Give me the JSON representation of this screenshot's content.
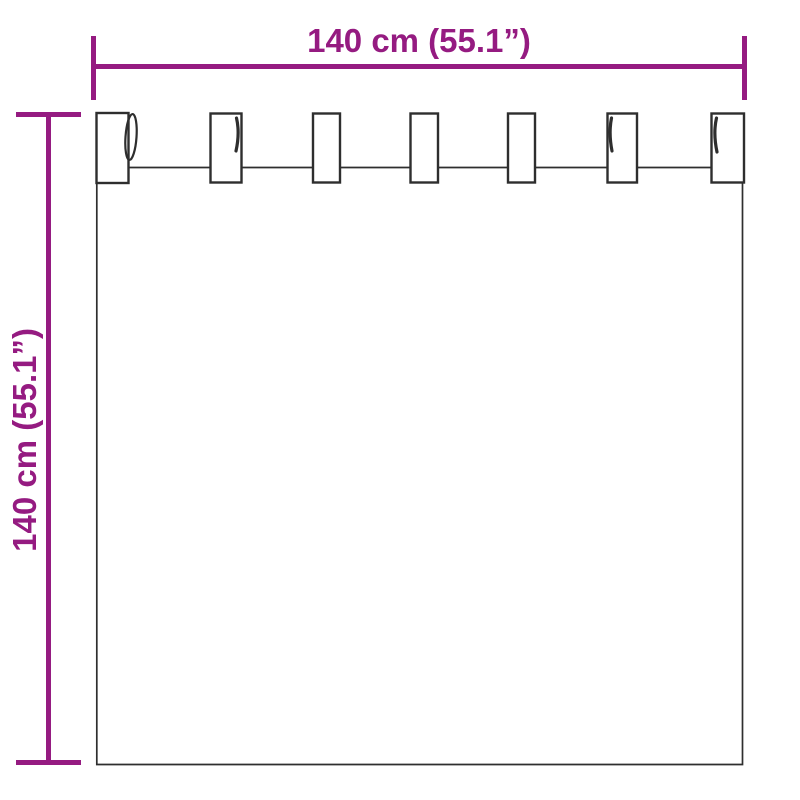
{
  "diagram": {
    "width_dimension": {
      "label": "140 cm (55.1”)"
    },
    "height_dimension": {
      "label": "140 cm (55.1”)"
    },
    "curtain": {
      "tab_count": 7
    },
    "colors": {
      "dimension_accent": "#951b81",
      "outline": "#2e2e2e",
      "background": "#ffffff"
    }
  }
}
